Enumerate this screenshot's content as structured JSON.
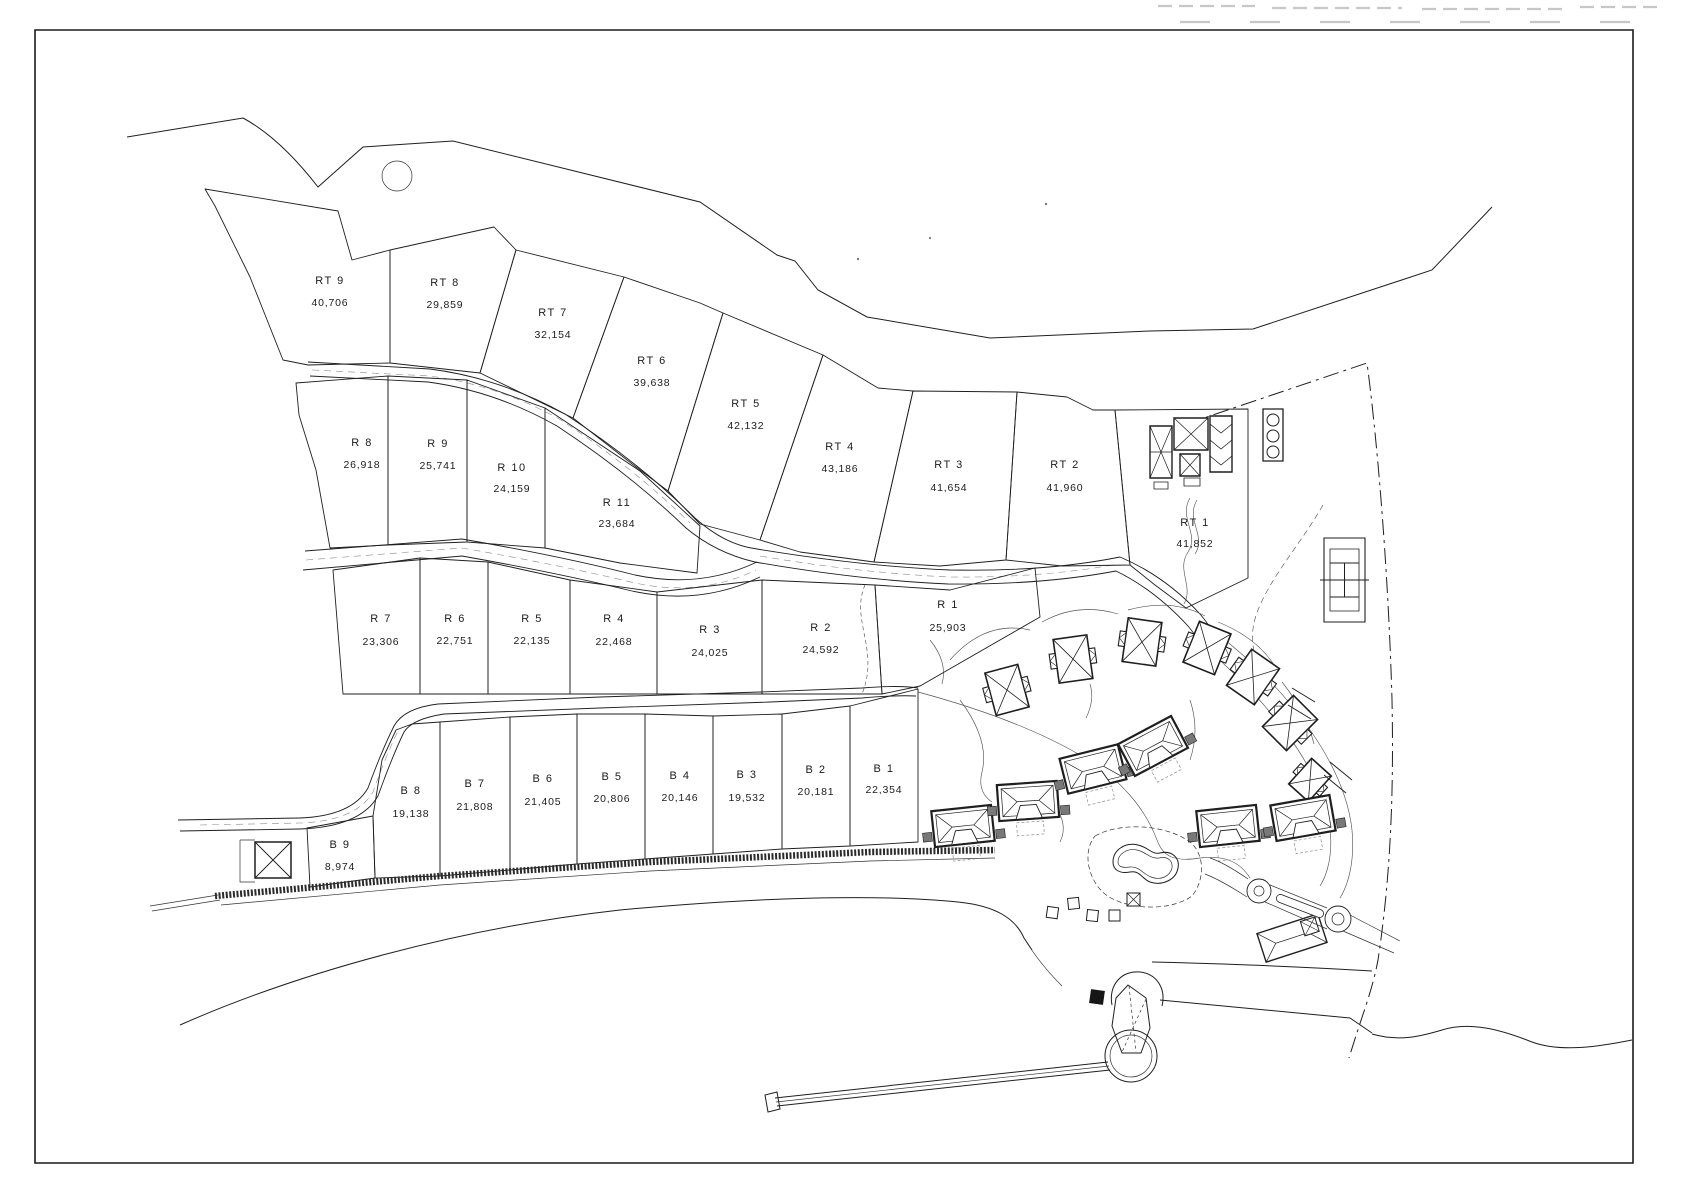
{
  "drawing": {
    "kind": "land-parcel site plan",
    "colors": {
      "ink": "#1f1f1f",
      "paper": "#ffffff"
    }
  },
  "plots": [
    {
      "code": "RT 9",
      "area": "40,706"
    },
    {
      "code": "RT 8",
      "area": "29,859"
    },
    {
      "code": "RT 7",
      "area": "32,154"
    },
    {
      "code": "RT 6",
      "area": "39,638"
    },
    {
      "code": "RT 5",
      "area": "42,132"
    },
    {
      "code": "RT 4",
      "area": "43,186"
    },
    {
      "code": "RT 3",
      "area": "41,654"
    },
    {
      "code": "RT 2",
      "area": "41,960"
    },
    {
      "code": "RT 1",
      "area": "41,852"
    },
    {
      "code": "R 8",
      "area": "26,918"
    },
    {
      "code": "R 9",
      "area": "25,741"
    },
    {
      "code": "R 10",
      "area": "24,159"
    },
    {
      "code": "R 11",
      "area": "23,684"
    },
    {
      "code": "R 7",
      "area": "23,306"
    },
    {
      "code": "R 6",
      "area": "22,751"
    },
    {
      "code": "R 5",
      "area": "22,135"
    },
    {
      "code": "R 4",
      "area": "22,468"
    },
    {
      "code": "R 3",
      "area": "24,025"
    },
    {
      "code": "R 2",
      "area": "24,592"
    },
    {
      "code": "R 1",
      "area": "25,903"
    },
    {
      "code": "B 8",
      "area": "19,138"
    },
    {
      "code": "B 7",
      "area": "21,808"
    },
    {
      "code": "B 6",
      "area": "21,405"
    },
    {
      "code": "B 5",
      "area": "20,806"
    },
    {
      "code": "B 4",
      "area": "20,146"
    },
    {
      "code": "B 3",
      "area": "19,532"
    },
    {
      "code": "B 2",
      "area": "20,181"
    },
    {
      "code": "B 1",
      "area": "22,354"
    },
    {
      "code": "B 9",
      "area": "8,974"
    }
  ]
}
